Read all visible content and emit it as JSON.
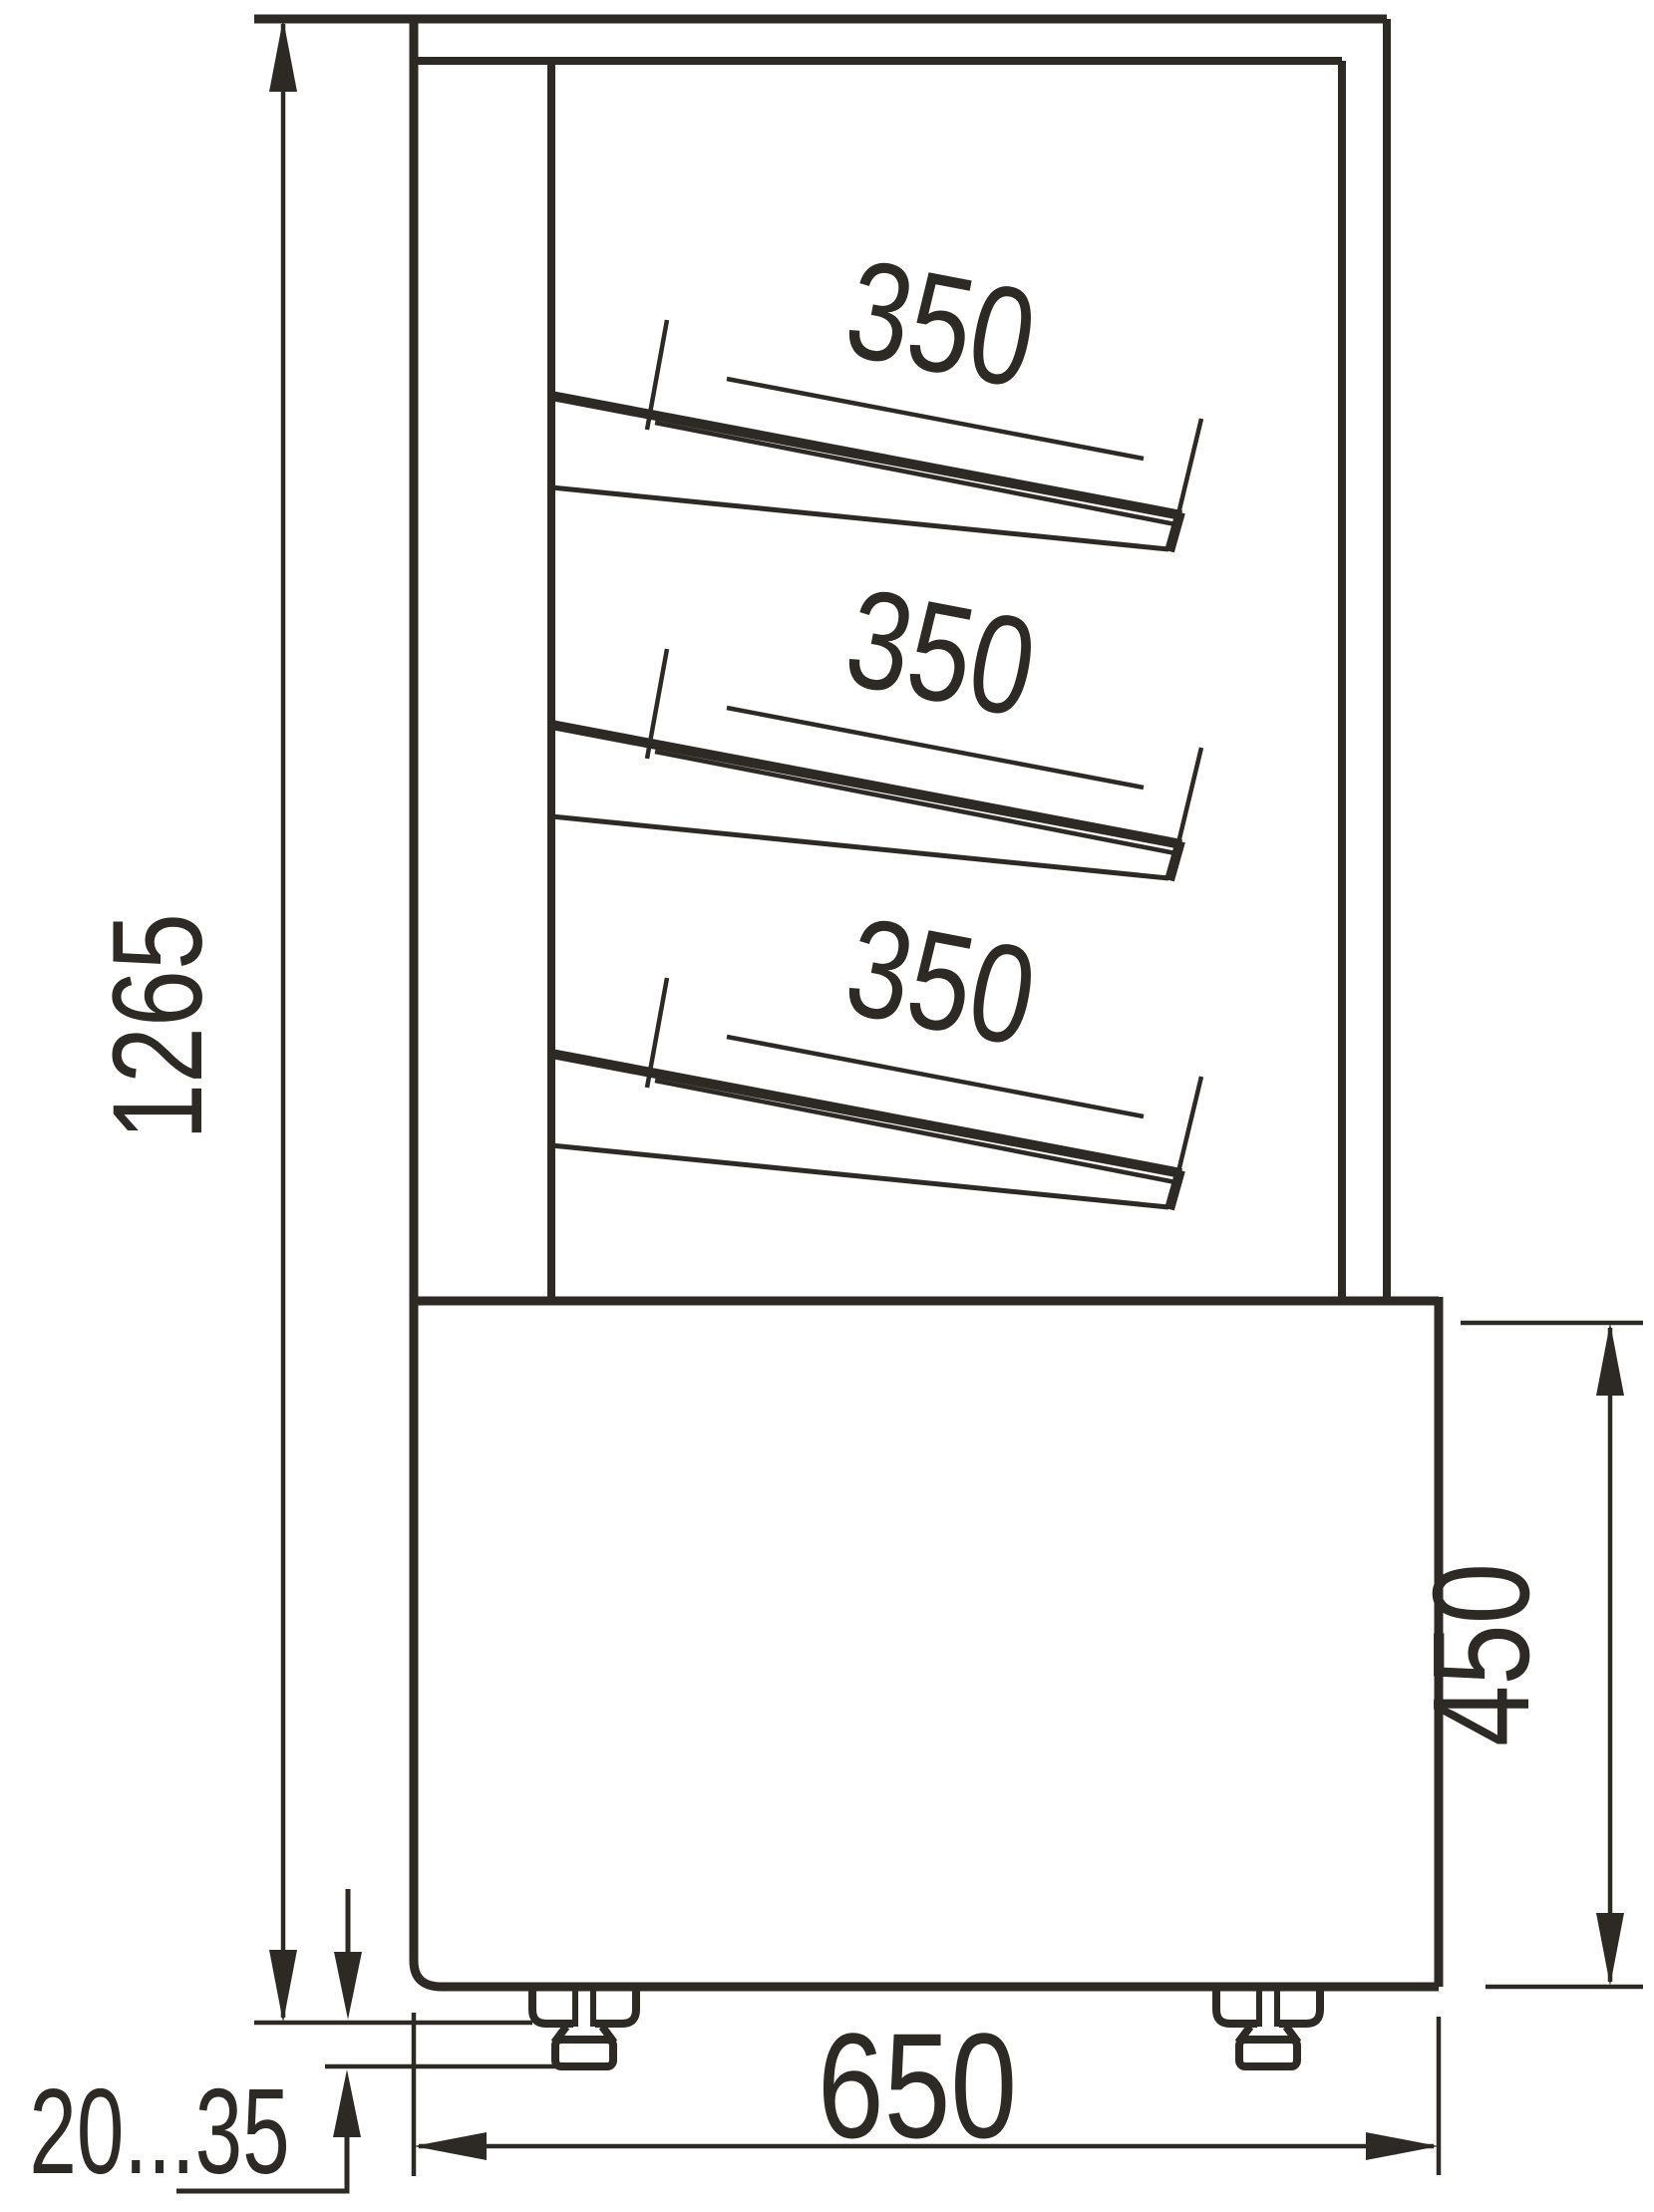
{
  "drawing": {
    "kind": "technical dimension drawing",
    "subject": "display case side view",
    "background_color": "#ffffff",
    "line_color": "#2d2a26",
    "shelf_count": 3
  },
  "dimensions": {
    "overall_height": {
      "label": "1265"
    },
    "base_height": {
      "label": "450"
    },
    "depth": {
      "label": "650"
    },
    "foot_adjust_range": {
      "label": "20...35"
    },
    "shelves": [
      {
        "label": "350"
      },
      {
        "label": "350"
      },
      {
        "label": "350"
      }
    ]
  }
}
